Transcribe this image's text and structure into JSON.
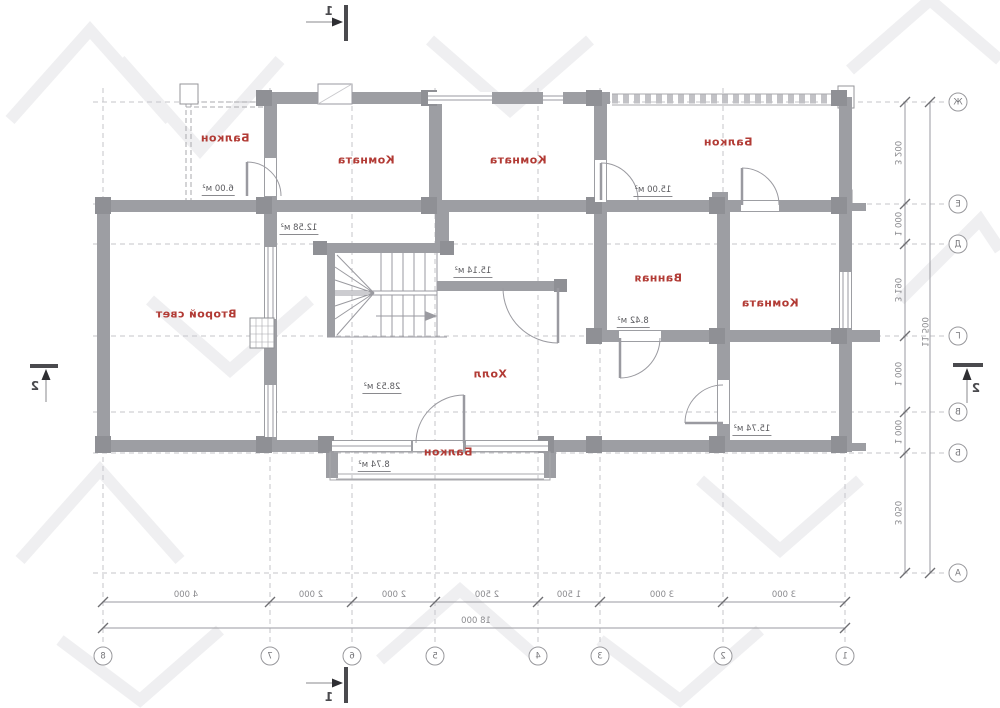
{
  "plan": {
    "rooms": [
      {
        "name": "Балкон",
        "area": "6.00 м²"
      },
      {
        "name": "Комната",
        "area": "12.58 м²"
      },
      {
        "name": "Комната",
        "area": "15.14 м²"
      },
      {
        "name": "Балкон",
        "area": "15.00 м²"
      },
      {
        "name": "Ванная",
        "area": "8.42 м²"
      },
      {
        "name": "Комната",
        "area": "15.74 м²"
      },
      {
        "name": "Второй свет"
      },
      {
        "name": "Холл",
        "area": "28.53 м²"
      },
      {
        "name": "Балкон",
        "area": "8.74 м²"
      }
    ],
    "axes_bottom": [
      "8",
      "7",
      "6",
      "5",
      "4",
      "3",
      "2",
      "1"
    ],
    "axes_right": [
      "Ж",
      "Е",
      "Д",
      "Г",
      "В",
      "Б",
      "А"
    ],
    "dims_bottom": [
      "4 000",
      "2 000",
      "2 000",
      "2 500",
      "1 500",
      "3 000",
      "3 000"
    ],
    "dim_bottom_total": "18 000",
    "dims_right": [
      "3 200",
      "1 000",
      "3 190",
      "1 000",
      "1 000",
      "3 050"
    ],
    "dim_right_total": "11 500",
    "sections": {
      "top": "1",
      "bottom": "1",
      "left": "2",
      "right": "2"
    }
  }
}
